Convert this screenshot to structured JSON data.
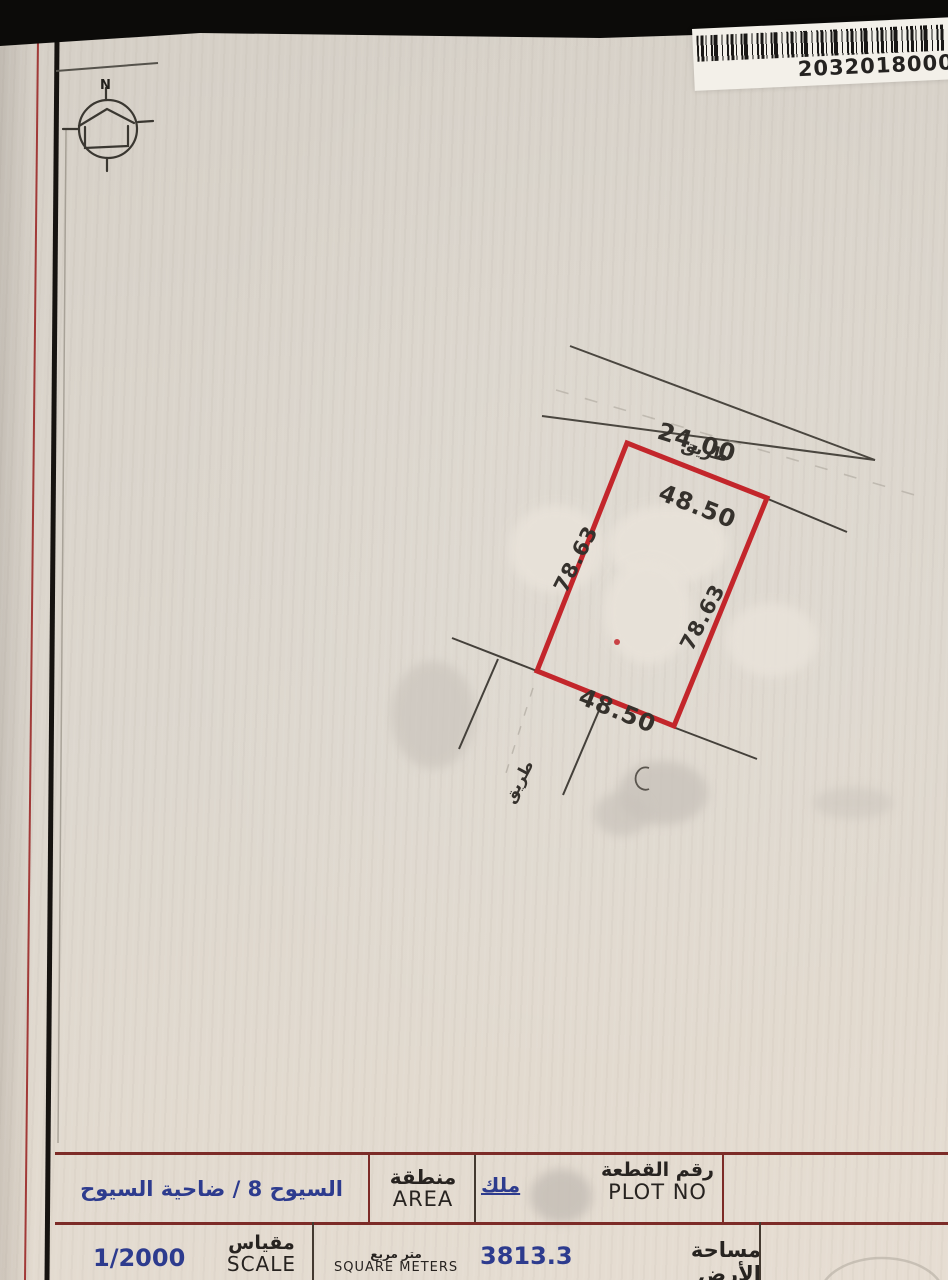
{
  "document": {
    "barcode_number": "2032018000",
    "compass_label": "N"
  },
  "drawing": {
    "road_top_width": "24.00",
    "road_top_label": "طريق",
    "road_side_label": "طريق",
    "plot_top": "48.50",
    "plot_bottom": "48.50",
    "plot_left": "78.63",
    "plot_right": "78.63"
  },
  "info_table": {
    "area_value": "السيوح 8 / ضاحية السيوح",
    "area_label_ar": "منطقة",
    "area_label_en": "AREA",
    "owner_label_ar": "ملك",
    "plot_no_label_ar": "رقم القطعة",
    "plot_no_label_en": "PLOT NO",
    "scale_value": "1/2000",
    "scale_label_ar": "مقياس",
    "scale_label_en": "SCALE",
    "land_area_value": "3813.3",
    "land_area_unit_ar": "متر مربع",
    "land_area_unit_en": "SQUARE METERS",
    "land_area_label_ar": "مساحة الأرض"
  }
}
